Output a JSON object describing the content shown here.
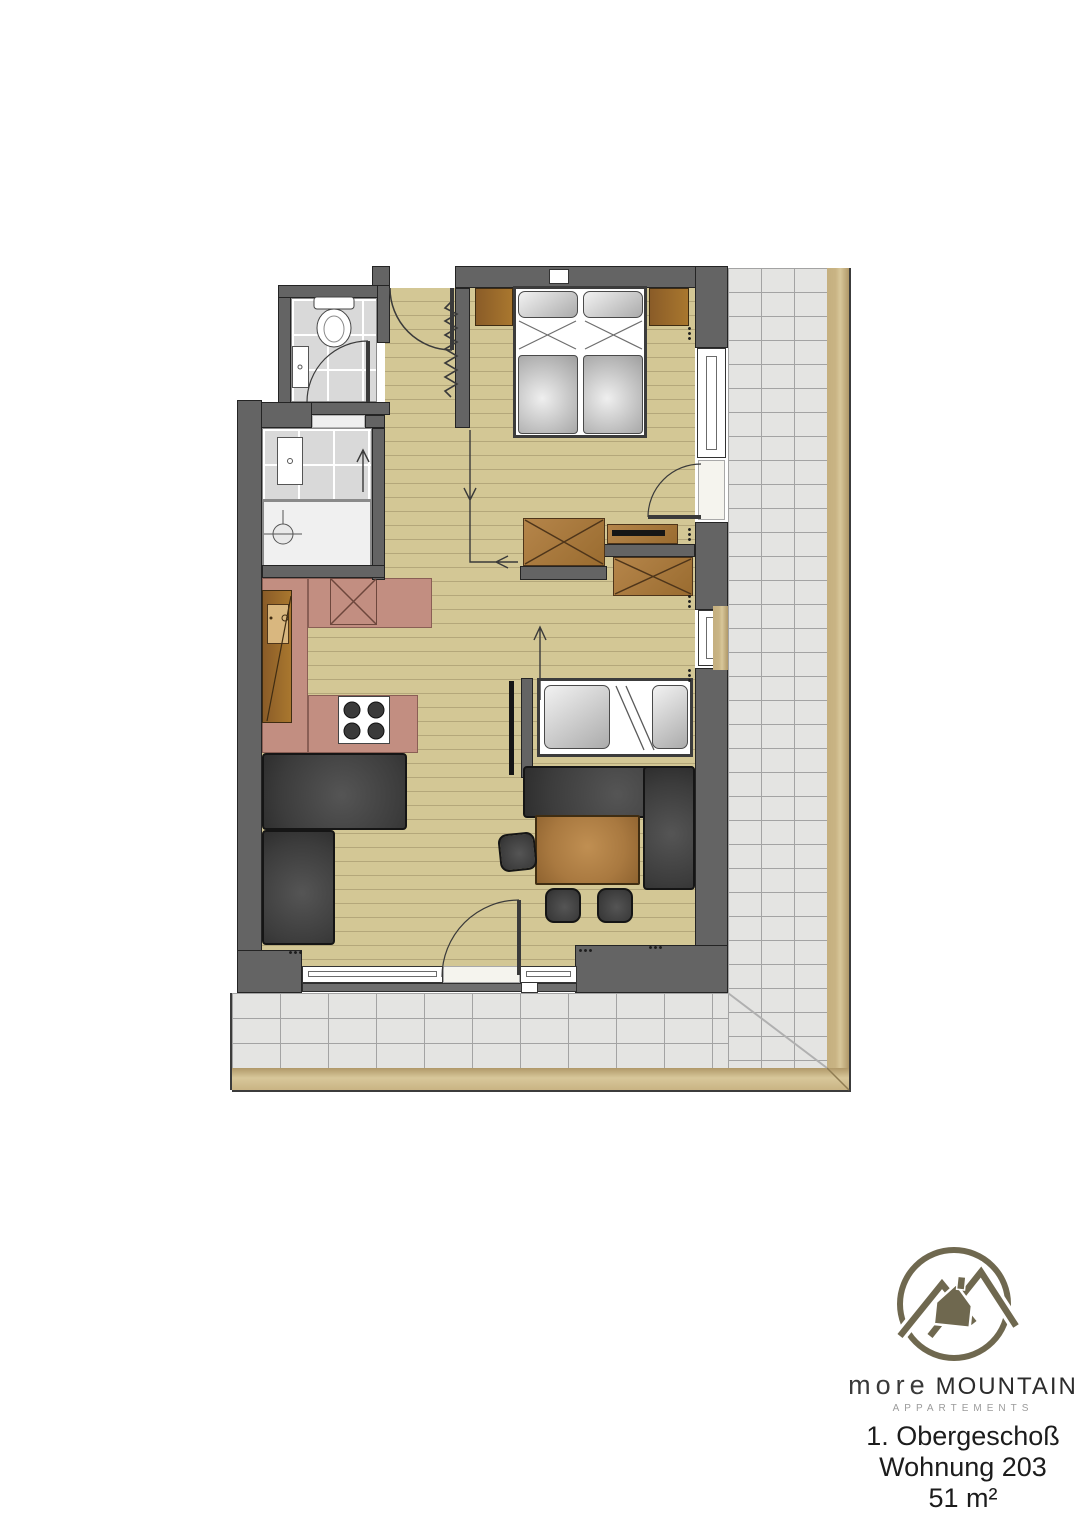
{
  "brand": {
    "name_light": "more",
    "name_bold": "MOUNTAIN",
    "subtitle": "APPARTEMENTS"
  },
  "title": {
    "floor": "1. Obergeschoß",
    "unit": "Wohnung 203",
    "area": "51 m²"
  },
  "palette": {
    "wood_floor": "#d3c795",
    "wood_line": "#b4a77a",
    "wall_gray": "#646464",
    "bath_tile": "#d9d9d9",
    "balcony_tile": "#e4e4e2",
    "kitchen_pink": "#c28e81",
    "furniture_brown": "#a97a3e",
    "sofa_dark": "#3c3c3c",
    "balcony_border_tan": "#c9b484",
    "logo_olive": "#6f684f"
  }
}
